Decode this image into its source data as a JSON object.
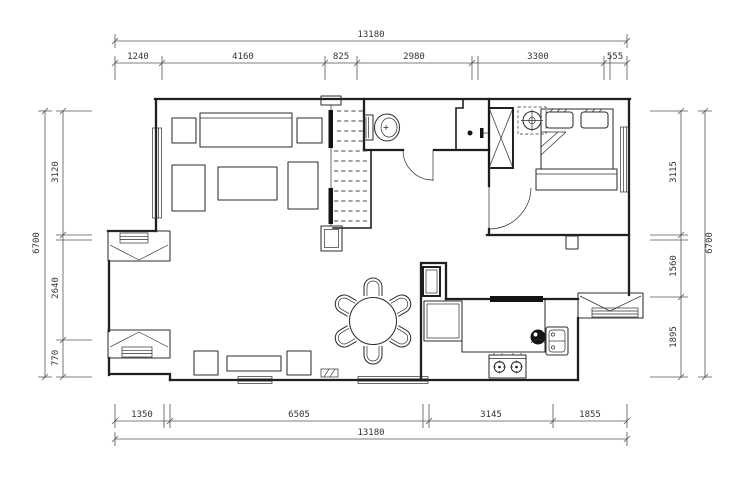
{
  "meta": {
    "background": "#ffffff",
    "wall_color": "#1f1f1f",
    "dim_line_color": "#555555",
    "dim_text_color": "#333333",
    "drawing_type": "apartment-floor-plan"
  },
  "dimensions": {
    "top": {
      "overall": "13180",
      "segments": [
        "1240",
        "4160",
        "825",
        "2980",
        "3300",
        "555"
      ]
    },
    "bottom": {
      "overall": "13180",
      "segments": [
        "1350",
        "6505",
        "3145",
        "1855"
      ]
    },
    "left": {
      "overall": "6700",
      "segments": [
        "3120",
        "2640",
        "770"
      ]
    },
    "right": {
      "overall": "6700",
      "segments": [
        "3115",
        "1560",
        "1895"
      ]
    }
  },
  "symbols": [
    "sofa-icon",
    "coffee-table-icon",
    "armchair-icon",
    "window-icon",
    "bay-window-icon",
    "staircase-icon",
    "toilet-icon",
    "wardrobe-icon",
    "ceiling-lamp-icon",
    "double-bed-icon",
    "dining-table-icon",
    "chair-icon",
    "fridge-icon",
    "kitchen-counter-icon",
    "stove-icon",
    "sink-icon",
    "door-swing-icon",
    "column-icon",
    "tv-cabinet-icon",
    "floor-mat-icon"
  ]
}
